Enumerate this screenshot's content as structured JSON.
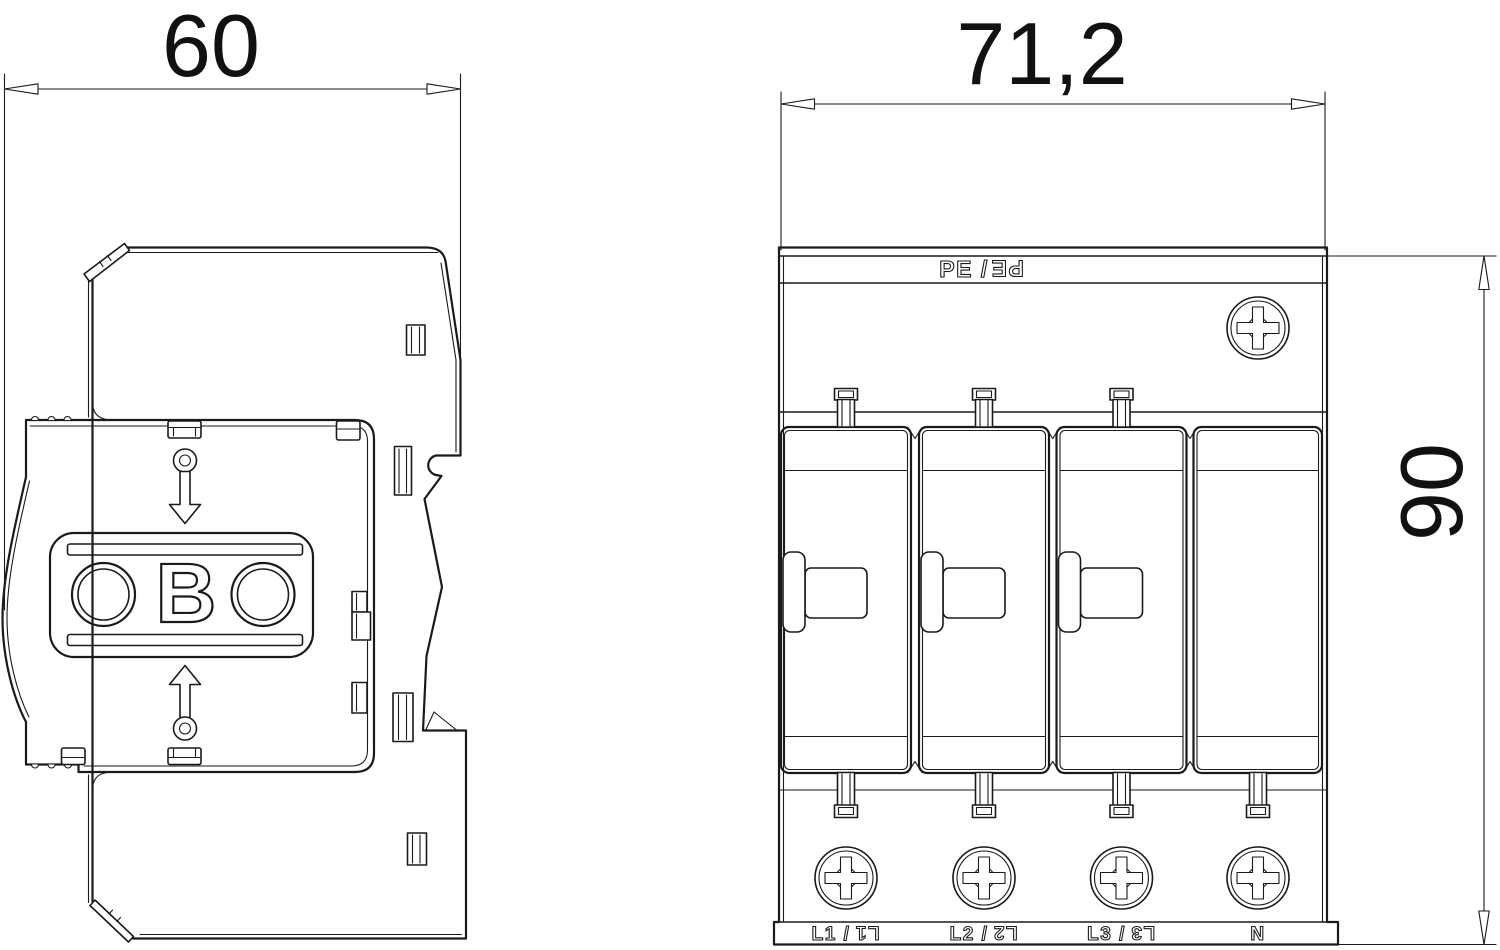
{
  "drawing": {
    "background_color": "#ffffff",
    "line_color": "#1a1a1a",
    "dimensions": {
      "side_width": "60",
      "front_width": "71,2",
      "front_height": "90"
    },
    "side_view": {
      "logo_letter": "B"
    },
    "front_view": {
      "pe_label": {
        "normal": "PE /",
        "rotated": "PE"
      },
      "terminals": [
        {
          "normal": "L1 /",
          "rotated": "L1"
        },
        {
          "normal": "L2 /",
          "rotated": "L2"
        },
        {
          "normal": "L3 /",
          "rotated": "L3"
        },
        {
          "normal": "N",
          "rotated": ""
        }
      ]
    }
  }
}
